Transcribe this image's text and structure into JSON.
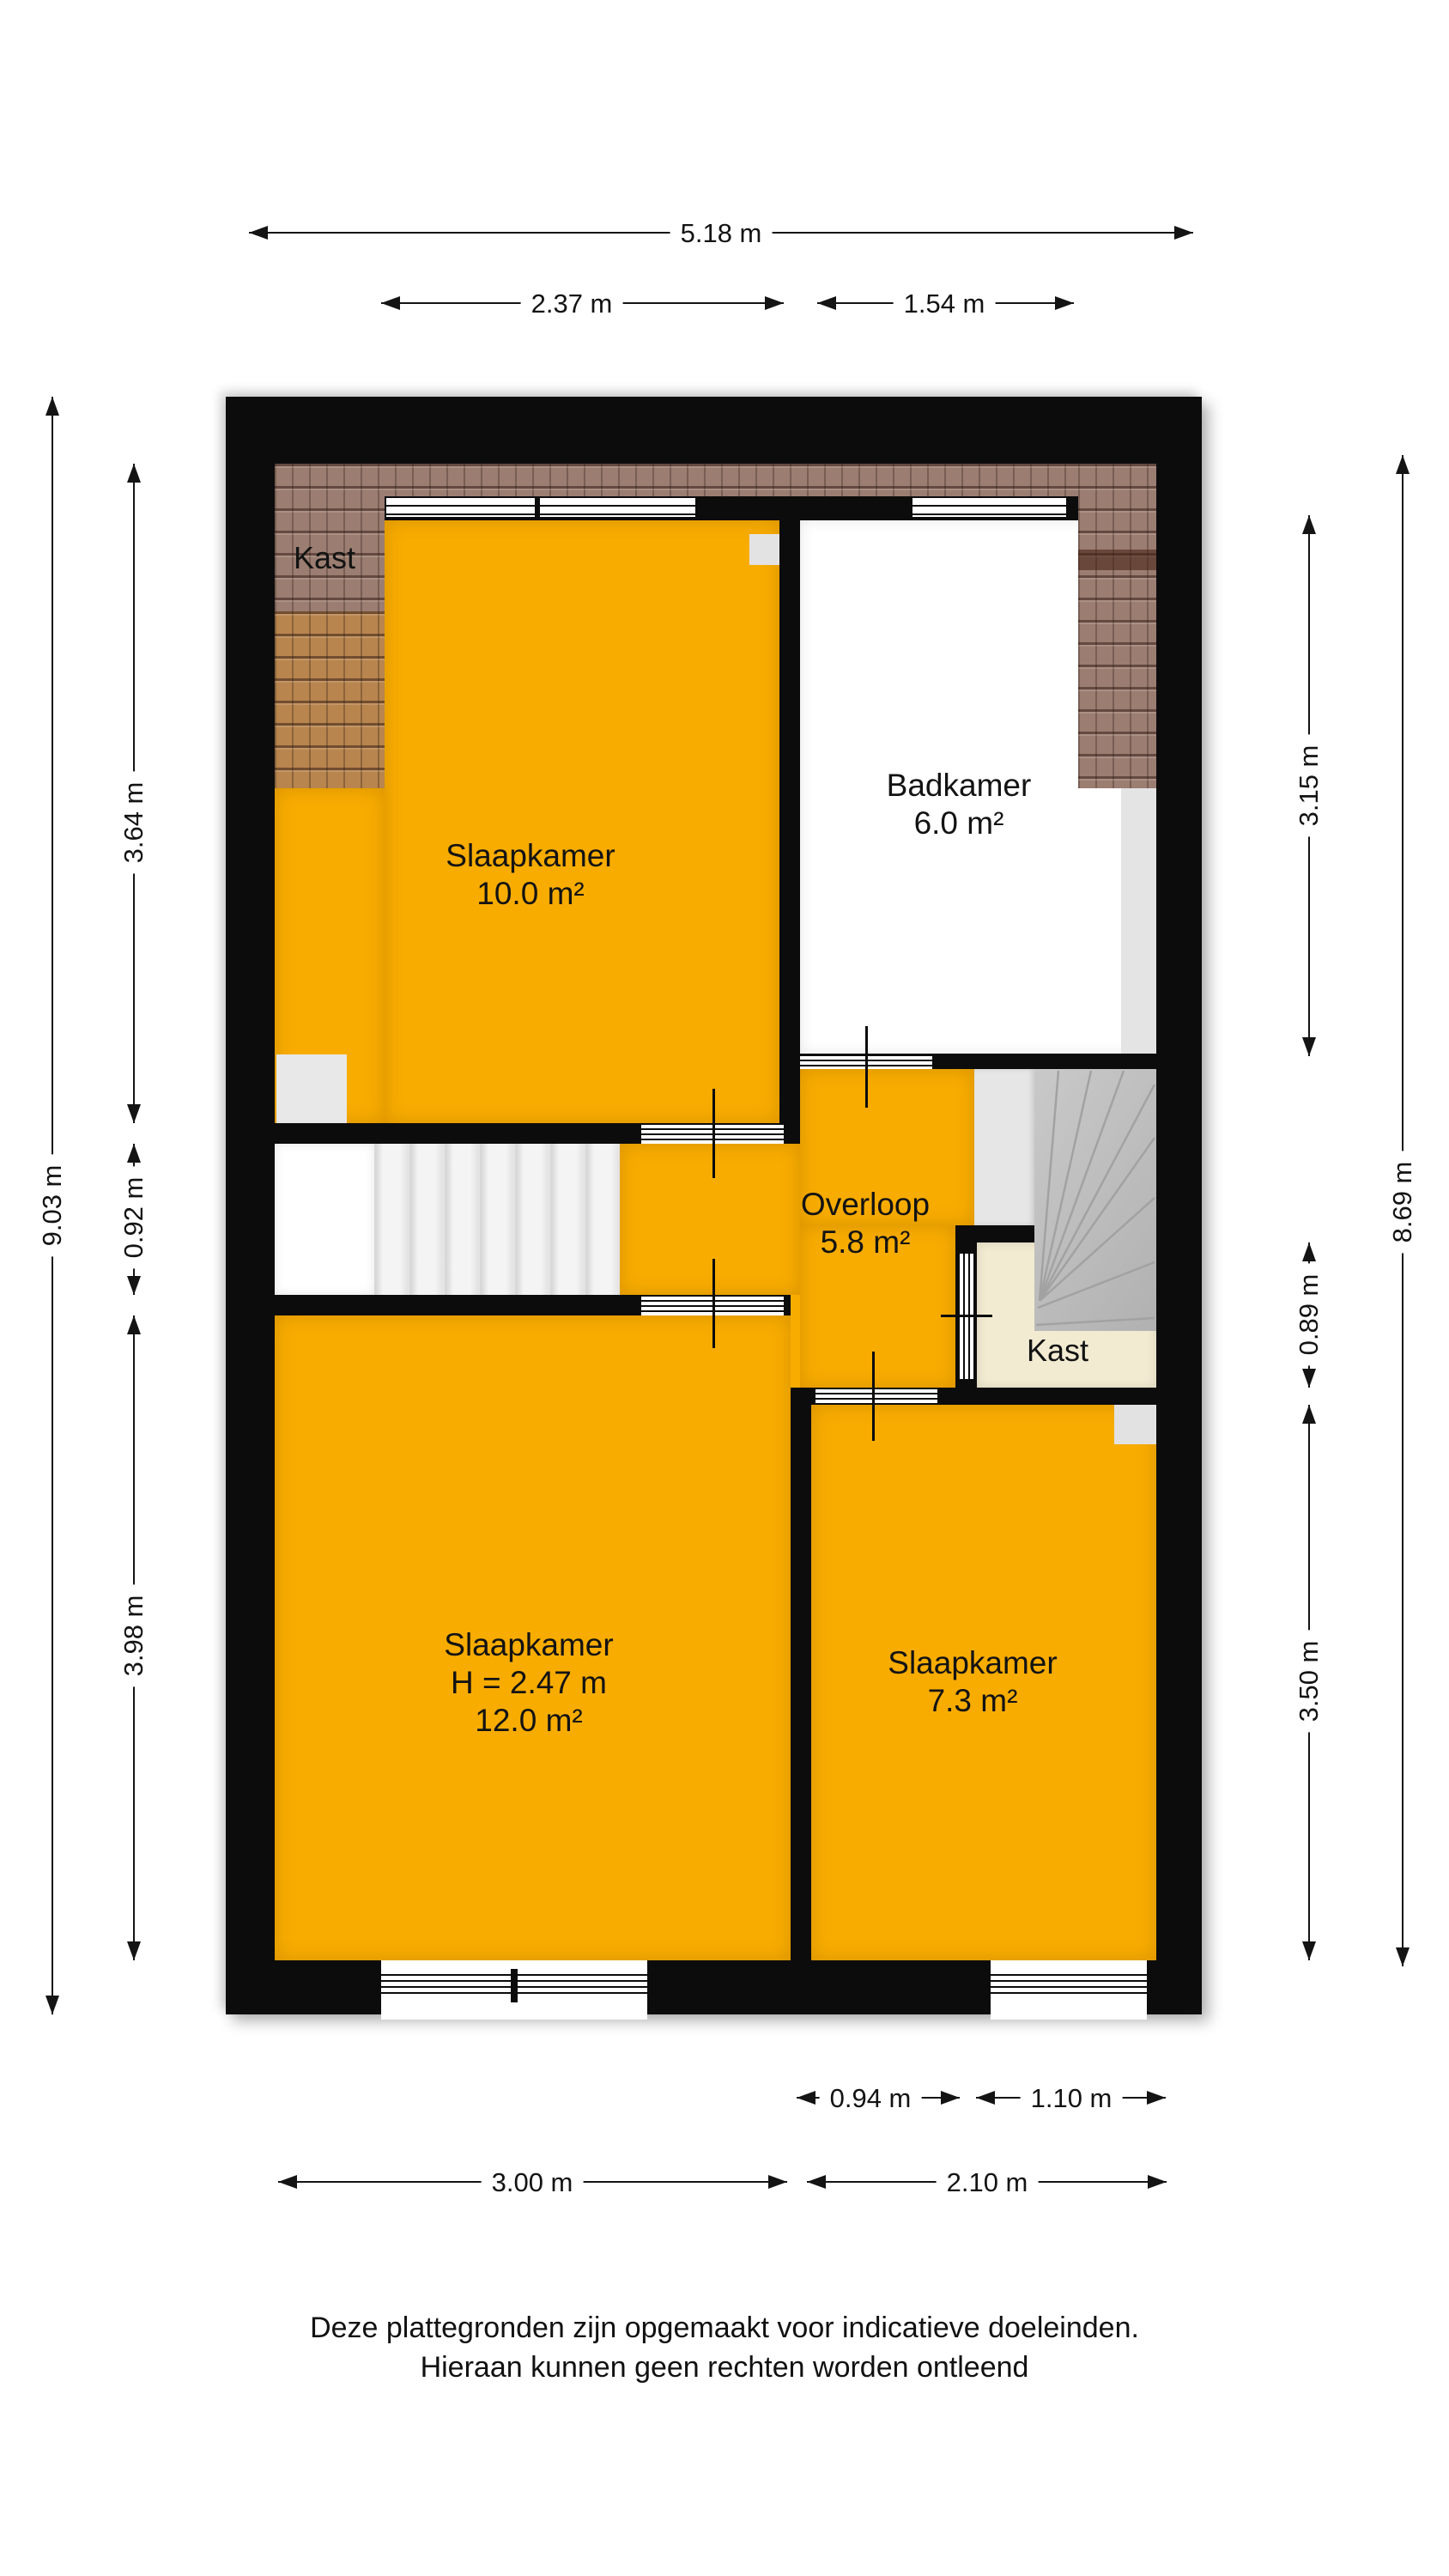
{
  "rooms": {
    "closet_top": {
      "name": "Kast"
    },
    "bedroom_large": {
      "name": "Slaapkamer",
      "area": "10.0 m²"
    },
    "bathroom": {
      "name": "Badkamer",
      "area": "6.0 m²"
    },
    "landing_hall": {
      "name": "Overloop",
      "area": "5.8 m²"
    },
    "closet_mid": {
      "name": "Kast"
    },
    "bedroom_main": {
      "name": "Slaapkamer",
      "ceiling_height": "H = 2.47 m",
      "area": "12.0 m²"
    },
    "bedroom_small": {
      "name": "Slaapkamer",
      "area": "7.3 m²"
    }
  },
  "dimensions": {
    "top": [
      {
        "label": "5.18 m"
      },
      {
        "label": "2.37 m"
      },
      {
        "label": "1.54 m"
      }
    ],
    "bottom": [
      {
        "label": "0.94 m"
      },
      {
        "label": "1.10 m"
      },
      {
        "label": "3.00 m"
      },
      {
        "label": "2.10 m"
      }
    ],
    "left": [
      {
        "label": "9.03 m"
      },
      {
        "label": "3.64 m"
      },
      {
        "label": "0.92 m"
      },
      {
        "label": "3.98 m"
      }
    ],
    "right": [
      {
        "label": "8.69 m"
      },
      {
        "label": "3.15 m"
      },
      {
        "label": "0.89 m"
      },
      {
        "label": "3.50 m"
      }
    ]
  },
  "footer": {
    "line1": "Deze plattegronden zijn opgemaakt voor indicatieve doeleinden.",
    "line2": "Hieraan kunnen geen rechten worden ontleend"
  },
  "colors": {
    "room_fill": "#F8AC00",
    "wall": "#0C0C0C",
    "closet_fill": "#F2EBD2",
    "roof_tiles_dark": "#9B7D71",
    "roof_tiles_light": "#B8854E",
    "stairs_gray": "#BDBDBD",
    "background": "#FFFFFF"
  }
}
